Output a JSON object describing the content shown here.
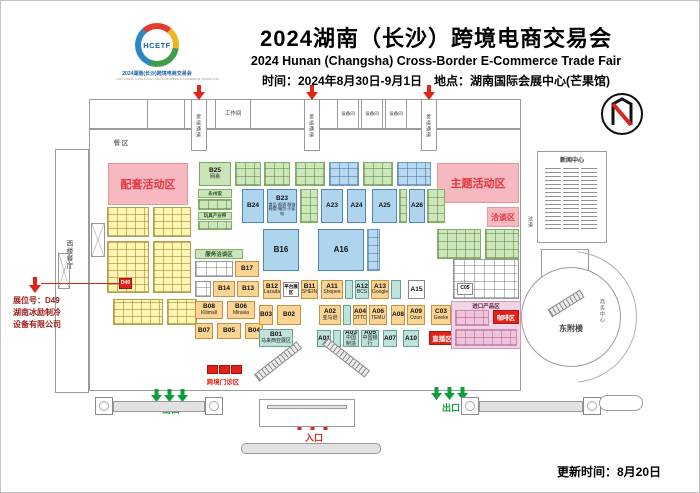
{
  "header": {
    "logo_text": "HCETF",
    "logo_caption": "2024湖南(长沙)跨境电商交易会",
    "logo_caption_en": "2024 HUNAN (CHANGSHA) CROSS-BORDER E-COMMERCE TRADE FAIR",
    "title": "2024湖南（长沙）跨境电商交易会",
    "subtitle": "2024 Hunan (Changsha) Cross-Border E-Commerce Trade Fair",
    "info": "时间：2024年8月30日-9月1日　地点：湖南国际会展中心(芒果馆)"
  },
  "callout": {
    "booth_no": "展位号：D49",
    "company_line1": "湖南冰励制冷",
    "company_line2": "设备有限公司"
  },
  "footer": {
    "updated": "更新时间：8月20日"
  },
  "zones": {
    "peitao": "配套活动区",
    "zhuti": "主题活动区",
    "qiatan": "洽谈区",
    "fuwu": "服务洽谈区",
    "pingtai": "平台展区",
    "jinkou": "进口产品区",
    "kafei": "咖啡区",
    "zhibo": "直播区",
    "clinic": "跨境门诊区",
    "canqu": "餐  区",
    "xilou": "西楼餐厅",
    "workroom": "工作间",
    "equip": "设备间",
    "freight": "货运通道",
    "news": "新闻中心",
    "aisle": "过道",
    "dongfulou": "东附楼",
    "biz": "商务中心",
    "exit": "出口",
    "entrance": "入口",
    "yongzhou": "永州馆",
    "toys": "玩具产业带"
  },
  "booths": {
    "b25": {
      "id": "B25",
      "brand": "网易"
    },
    "b24": {
      "id": "B24"
    },
    "b23": {
      "id": "B23",
      "desc1": "食品·烟酒·服饰",
      "desc2": "鞋帽·箱包·小家电"
    },
    "a23": {
      "id": "A23"
    },
    "a24": {
      "id": "A24"
    },
    "a25": {
      "id": "A25"
    },
    "a26": {
      "id": "A26"
    },
    "b16": {
      "id": "B16"
    },
    "a16": {
      "id": "A16"
    },
    "a15": {
      "id": "A15"
    },
    "b17": {
      "id": "B17"
    },
    "b14": {
      "id": "B14"
    },
    "b13": {
      "id": "B13"
    },
    "b12": {
      "id": "B12",
      "brand": "Lazada"
    },
    "b11": {
      "id": "B11",
      "brand": "SHEIN"
    },
    "a11": {
      "id": "A11",
      "brand": "Shopee"
    },
    "a12": {
      "id": "A12",
      "brand": "BCS"
    },
    "a13": {
      "id": "A13",
      "brand": "Google"
    },
    "b08": {
      "id": "B08",
      "brand": "Kilimall"
    },
    "b07": {
      "id": "B07"
    },
    "b06": {
      "id": "B06",
      "brand": "Miravia"
    },
    "b05": {
      "id": "B05"
    },
    "b04": {
      "id": "B04"
    },
    "b03": {
      "id": "B03"
    },
    "b02": {
      "id": "B02"
    },
    "b01": {
      "id": "B01",
      "brand": "马来西亚展区"
    },
    "a01": {
      "id": "A01"
    },
    "a02": {
      "id": "A02",
      "brand": "亚马逊"
    },
    "a03": {
      "id": "A03",
      "brand": "中国制造"
    },
    "a04": {
      "id": "A04",
      "brand": "OTTO"
    },
    "a05": {
      "id": "A05",
      "brand": "中国银行"
    },
    "a06": {
      "id": "A06",
      "brand": "TEMU"
    },
    "a07": {
      "id": "A07"
    },
    "a08": {
      "id": "A08"
    },
    "a09": {
      "id": "A09",
      "brand": "Ozon"
    },
    "a10": {
      "id": "A10"
    },
    "c03": {
      "id": "C03",
      "brand": "Geeke"
    },
    "c05": {
      "id": "C05"
    },
    "d49": {
      "id": "D49"
    }
  }
}
